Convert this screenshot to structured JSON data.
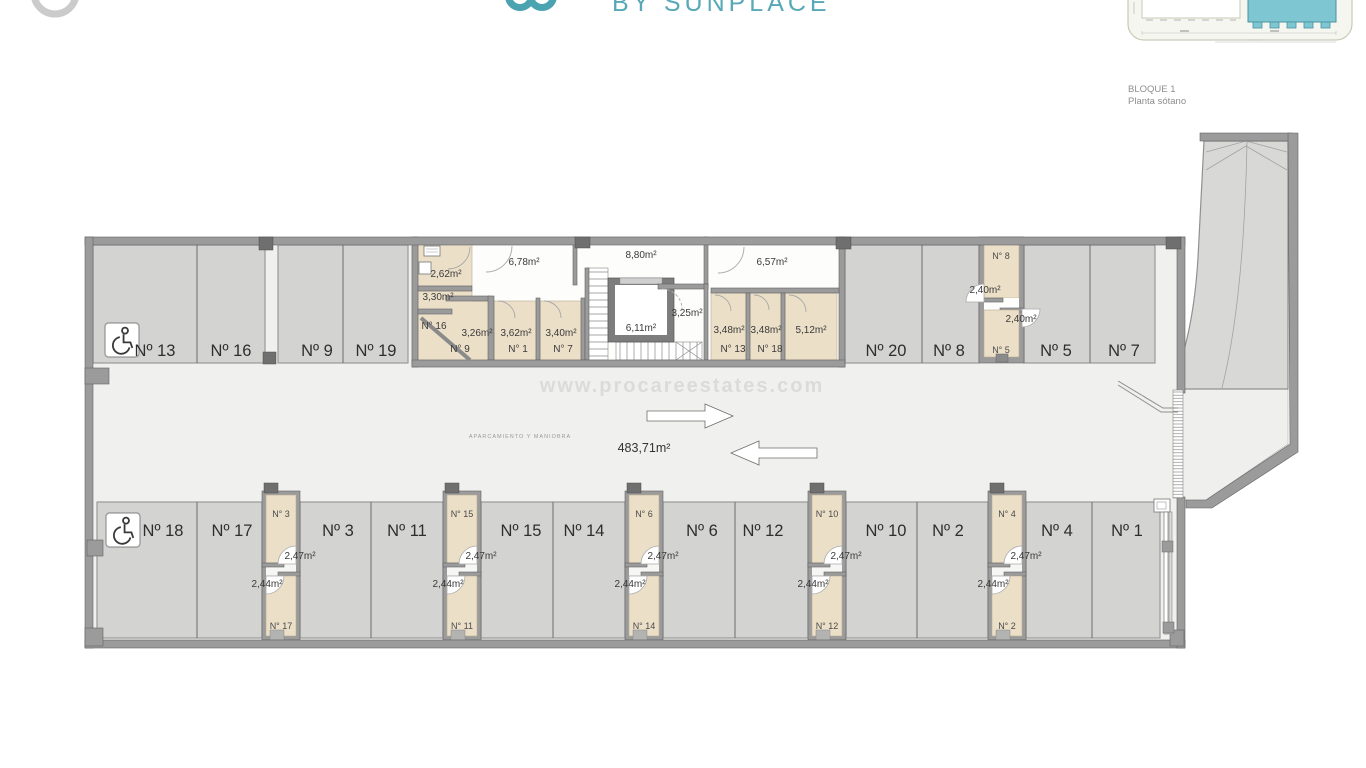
{
  "header": {
    "brand_text": "BY SUNPLACE",
    "caption_line1": "BLOQUE 1",
    "caption_line2": "Planta sótano"
  },
  "watermark": "www.procareestates.com",
  "plan": {
    "aisle_area": "483,71m²",
    "zone_label": "APARCAMIENTO Y MANIOBRA",
    "parking_top": [
      {
        "label": "Nº 13"
      },
      {
        "label": "Nº 16"
      },
      {
        "label": "Nº 9"
      },
      {
        "label": "Nº 19"
      },
      {
        "label": "Nº 20"
      },
      {
        "label": "Nº 8"
      },
      {
        "label": "Nº 5"
      },
      {
        "label": "Nº 7"
      }
    ],
    "parking_bottom": [
      {
        "label": "Nº 18"
      },
      {
        "label": "Nº 17"
      },
      {
        "label": "Nº 3"
      },
      {
        "label": "Nº 11"
      },
      {
        "label": "Nº 15"
      },
      {
        "label": "Nº 14"
      },
      {
        "label": "Nº 6"
      },
      {
        "label": "Nº 12"
      },
      {
        "label": "Nº 10"
      },
      {
        "label": "Nº 2"
      },
      {
        "label": "Nº 4"
      },
      {
        "label": "Nº 1"
      }
    ],
    "core": {
      "bath_area": "2,62m²",
      "room330": "3,30m²",
      "n16_label": "N° 16",
      "n9_area": "3,26m²",
      "n9_label": "N° 9",
      "hall_left": "6,78m²",
      "n1_area": "3,62m²",
      "n1_label": "N° 1",
      "n7_area": "3,40m²",
      "n7_label": "N° 7",
      "hall_mid": "8,80m²",
      "lift_area": "6,11m²",
      "room325": "3,25m²",
      "hall_right": "6,57m²",
      "n13_area": "3,48m²",
      "n13_label": "N° 13",
      "n18_area": "3,48m²",
      "n18_label": "N° 18",
      "room512": "5,12m²"
    },
    "storage_right": {
      "top_label": "N° 8",
      "top_area": "2,40m²",
      "bottom_label": "N° 5",
      "bottom_area": "2,40m²"
    },
    "storage_pairs": [
      {
        "top_label": "N° 3",
        "top_area": "2,47m²",
        "bottom_label": "N° 17",
        "bottom_area": "2,44m²"
      },
      {
        "top_label": "N° 15",
        "top_area": "2,47m²",
        "bottom_label": "N° 11",
        "bottom_area": "2,44m²"
      },
      {
        "top_label": "N° 6",
        "top_area": "2,47m²",
        "bottom_label": "N° 14",
        "bottom_area": "2,44m²"
      },
      {
        "top_label": "N° 10",
        "top_area": "2,47m²",
        "bottom_label": "N° 12",
        "bottom_area": "2,44m²"
      },
      {
        "top_label": "N° 4",
        "top_area": "2,47m²",
        "bottom_label": "N° 2",
        "bottom_area": "2,44m²"
      }
    ],
    "colors": {
      "brand_teal": "#57A9B8",
      "wall_gray": "#9B9B9B",
      "parking_fill": "#D3D3D2",
      "storage_fill": "#EBDFC8",
      "floor": "#F0F0EE",
      "thumb_teal": "#7EC7D2"
    }
  }
}
